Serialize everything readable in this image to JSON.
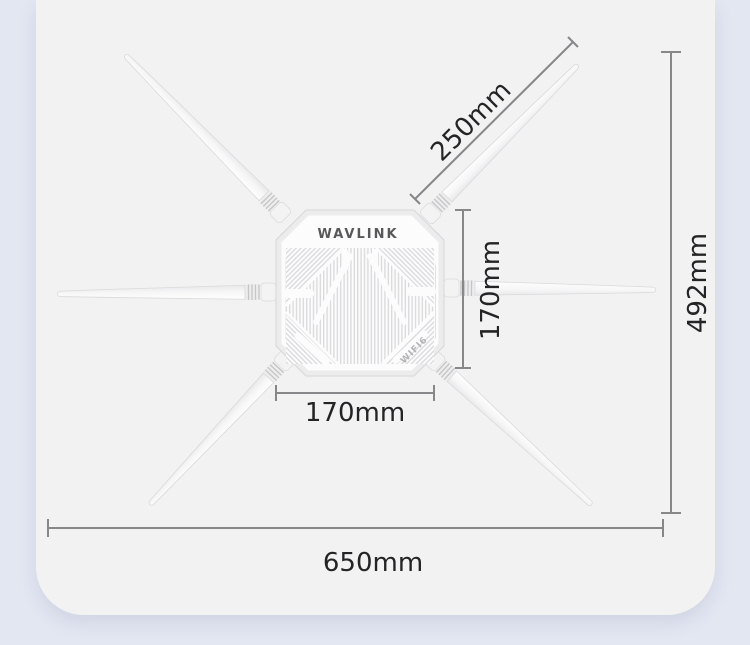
{
  "product": {
    "brand": "WAVLINK",
    "wifi_label": "WIFI6"
  },
  "dimensions": {
    "antenna_length": "250mm",
    "body_height": "170mm",
    "body_width": "170mm",
    "total_height": "492mm",
    "total_width": "650mm"
  }
}
